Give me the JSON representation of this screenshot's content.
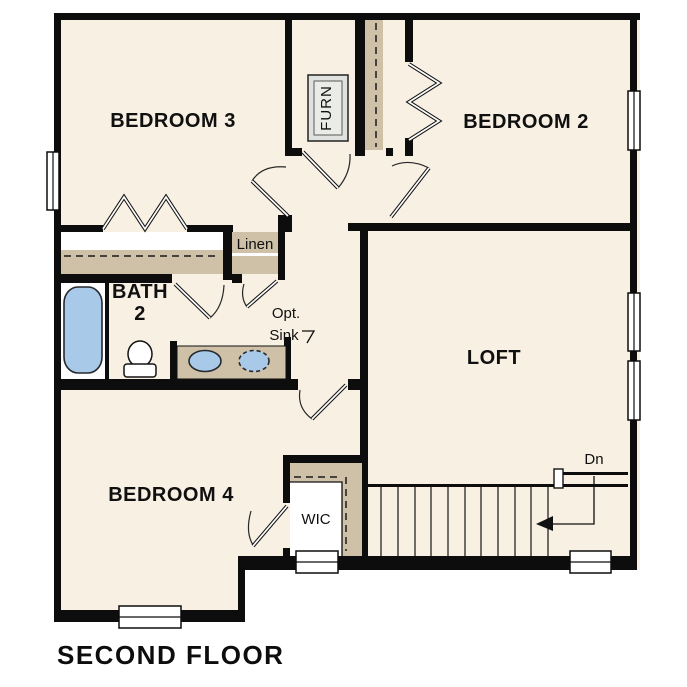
{
  "title": "SECOND FLOOR",
  "rooms": {
    "bedroom3": "BEDROOM 3",
    "bedroom2": "BEDROOM 2",
    "loft": "LOFT",
    "bedroom4": "BEDROOM 4",
    "bath_line1": "BATH",
    "bath_line2": "2",
    "wic": "WIC",
    "linen": "Linen",
    "furnace": "FURN",
    "opt_sink_line1": "Opt.",
    "opt_sink_line2": "Sink",
    "stairs_direction": "Dn"
  },
  "colors": {
    "background": "#ffffff",
    "wall": "#0d0d0d",
    "floor": "#f8f0e3",
    "millwork": "#cfc1a8",
    "fixture_blue": "#a9c9e9",
    "furn_fill": "#dfe2de"
  }
}
